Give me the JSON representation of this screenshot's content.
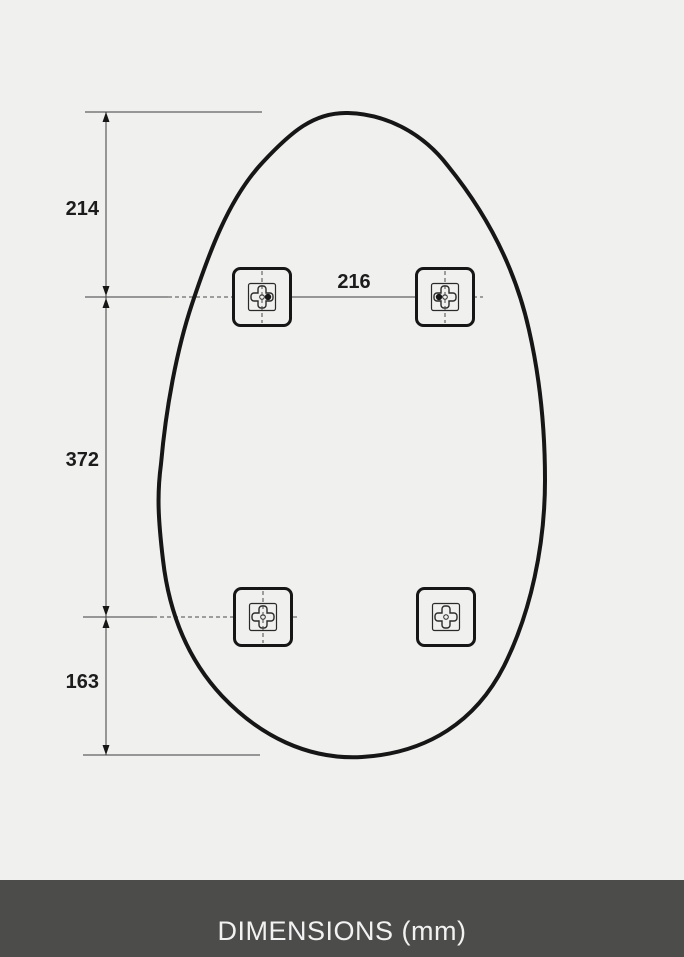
{
  "diagram": {
    "labels": {
      "top_to_bracket": "214",
      "bracket_to_bracket_vertical": "372",
      "bracket_to_bottom": "163",
      "bracket_to_bracket_horizontal": "216"
    }
  },
  "footer": {
    "label": "DIMENSIONS (mm)"
  },
  "colors": {
    "bg": "#f0f0ee",
    "ink": "#161616",
    "thin": "#3d3d3d",
    "dash": "#4a4a4a",
    "footer-bg": "#4c4c4a",
    "footer-text": "#f2f2f2"
  }
}
